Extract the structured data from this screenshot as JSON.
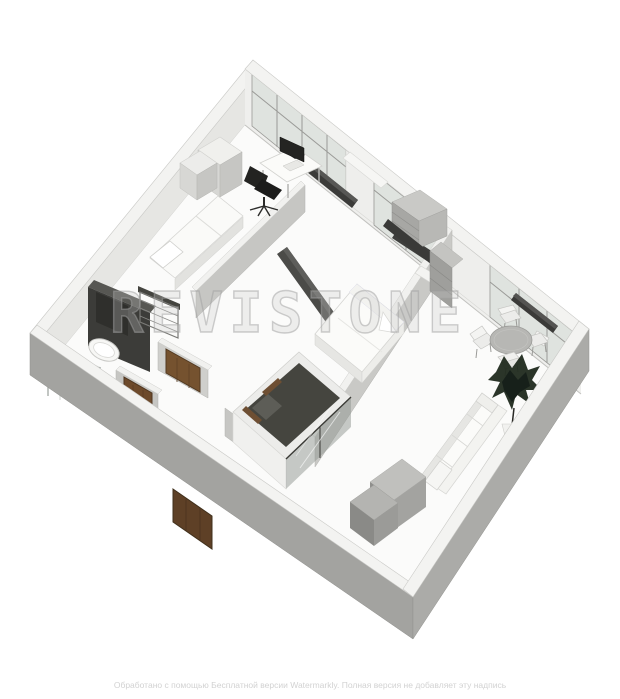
{
  "page": {
    "background": "#ffffff",
    "description": "3D axonometric Revit-style rendering of a one-bedroom apartment floor plan"
  },
  "watermark": {
    "brand_text": "REVISTONE"
  },
  "footer": {
    "notice_text": "Обработано с помощью Бесплатной версии Watermarkly. Полная версия не добавляет эту надпись"
  },
  "palette": {
    "wall_top": "#f3f3f1",
    "wall_outer_gray": "#a3a3a0",
    "wall_inner_light": "#e3e3e0",
    "window_glass": "#dfe3df",
    "window_frame": "#9a9a97",
    "dark_fixture": "#3c3c39",
    "door_wood": "#6d4a2b",
    "plant_foliage": "#202a1e",
    "white_furniture": "#fbfbf9"
  },
  "scene": {
    "view": "isometric-birds-eye",
    "rooms": [
      "study",
      "bathroom",
      "hallway",
      "bedroom",
      "walk-in-closet",
      "kitchen-living-room"
    ],
    "objects": [
      "curtain-wall-windows",
      "desk",
      "monitor",
      "office-chair",
      "wardrobe-cabinets",
      "single-bed",
      "shelving-unit",
      "sink",
      "toilet",
      "shower-glass",
      "interior-doors",
      "entrance-door",
      "double-bed",
      "tv-console",
      "glass-wardrobe",
      "dining-table",
      "dining-chairs",
      "potted-plant",
      "sofa",
      "kitchen-counter",
      "radiators"
    ]
  }
}
